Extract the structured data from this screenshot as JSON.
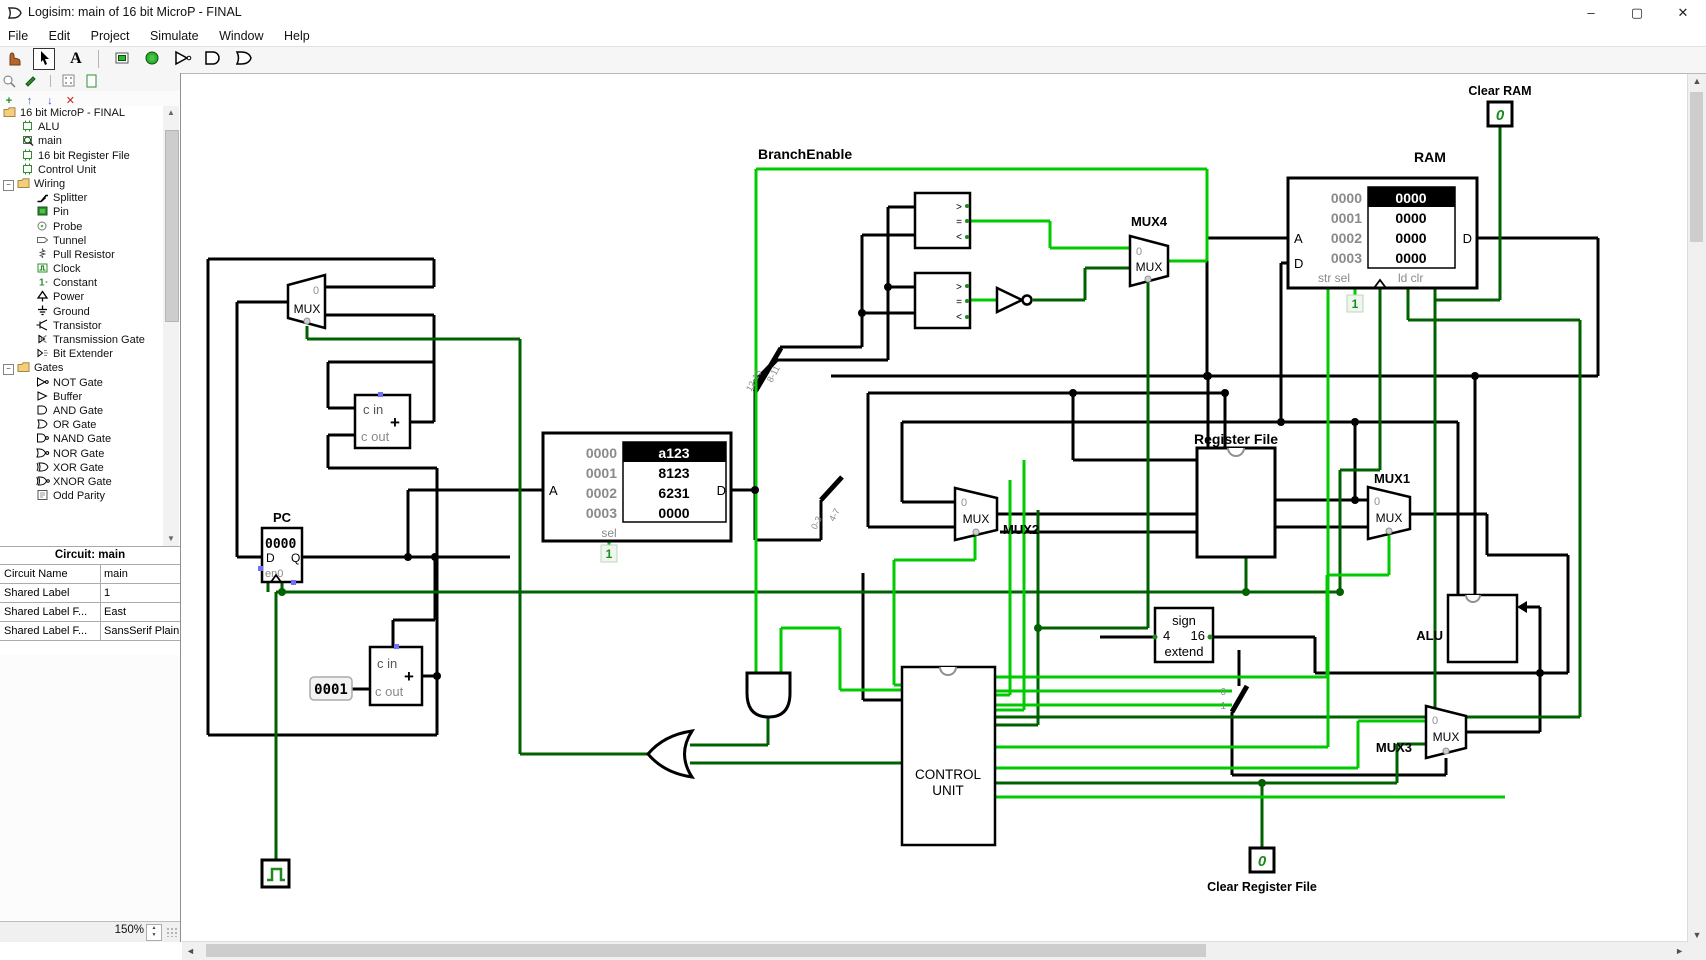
{
  "window": {
    "title": "Logisim: main of 16 bit MicroP - FINAL",
    "controls": {
      "minimize": "–",
      "maximize": "▢",
      "close": "✕"
    }
  },
  "menu": {
    "items": [
      "File",
      "Edit",
      "Project",
      "Simulate",
      "Window",
      "Help"
    ]
  },
  "toolbar": {
    "text_tool_glyph": "A",
    "tools": [
      "poke-tool",
      "edit-tool",
      "text-tool",
      "input-pin",
      "output-pin",
      "not-gate",
      "and-gate",
      "or-gate"
    ]
  },
  "explorer_toolbar": {
    "add": "+",
    "up": "↑",
    "down": "↓",
    "delete": "✕"
  },
  "explorer": {
    "items": [
      {
        "label": "16 bit MicroP - FINAL",
        "type": "project"
      },
      {
        "label": "ALU",
        "type": "circuit"
      },
      {
        "label": "main",
        "type": "circuit-current"
      },
      {
        "label": "16 bit Register File",
        "type": "circuit"
      },
      {
        "label": "Control Unit",
        "type": "circuit"
      },
      {
        "label": "Wiring",
        "type": "folder"
      },
      {
        "label": "Splitter",
        "type": "splitter"
      },
      {
        "label": "Pin",
        "type": "pin"
      },
      {
        "label": "Probe",
        "type": "probe"
      },
      {
        "label": "Tunnel",
        "type": "tunnel"
      },
      {
        "label": "Pull Resistor",
        "type": "pull-resistor"
      },
      {
        "label": "Clock",
        "type": "clock"
      },
      {
        "label": "Constant",
        "type": "constant"
      },
      {
        "label": "Power",
        "type": "power"
      },
      {
        "label": "Ground",
        "type": "ground"
      },
      {
        "label": "Transistor",
        "type": "transistor"
      },
      {
        "label": "Transmission Gate",
        "type": "transmission-gate"
      },
      {
        "label": "Bit Extender",
        "type": "bit-extender"
      },
      {
        "label": "Gates",
        "type": "folder"
      },
      {
        "label": "NOT Gate",
        "type": "not-gate"
      },
      {
        "label": "Buffer",
        "type": "buffer"
      },
      {
        "label": "AND Gate",
        "type": "and-gate"
      },
      {
        "label": "OR Gate",
        "type": "or-gate"
      },
      {
        "label": "NAND Gate",
        "type": "nand-gate"
      },
      {
        "label": "NOR Gate",
        "type": "nor-gate"
      },
      {
        "label": "XOR Gate",
        "type": "xor-gate"
      },
      {
        "label": "XNOR Gate",
        "type": "xnor-gate"
      },
      {
        "label": "Odd Parity",
        "type": "odd-parity"
      }
    ]
  },
  "properties": {
    "header": "Circuit: main",
    "rows": [
      {
        "label": "Circuit Name",
        "value": "main"
      },
      {
        "label": "Shared Label",
        "value": "1"
      },
      {
        "label": "Shared Label F...",
        "value": "East"
      },
      {
        "label": "Shared Label F...",
        "value": "SansSerif Plain..."
      }
    ]
  },
  "statusbar": {
    "zoom": "150%"
  },
  "icons": {
    "scroll_up": "▲",
    "scroll_down": "▼",
    "scroll_left": "◄",
    "scroll_right": "►",
    "spin_up": "▲",
    "spin_down": "▼",
    "tree_collapse": "−"
  },
  "colors": {
    "wire_on": "#00ca00",
    "wire_off": "#006100",
    "bus": "#000000",
    "gray_text": "#808080",
    "pin_green": "#2f8f2f"
  },
  "canvas": {
    "labels": {
      "branch_enable": "BranchEnable",
      "register_file": "Register File",
      "alu": "ALU",
      "pc": "PC",
      "control_l1": "CONTROL",
      "control_l2": "UNIT"
    },
    "muxes": {
      "mux_text": "MUX",
      "zero": "0",
      "mux1": "MUX1",
      "mux2": "MUX2",
      "mux3": "MUX3",
      "mux4": "MUX4"
    },
    "ram": {
      "title": "RAM",
      "rows": [
        {
          "addr": "0000",
          "value": "0000"
        },
        {
          "addr": "0001",
          "value": "0000"
        },
        {
          "addr": "0002",
          "value": "0000"
        },
        {
          "addr": "0003",
          "value": "0000"
        }
      ],
      "port_a": "A",
      "port_d_in": "D",
      "port_d_out": "D",
      "bottom_left": "str sel",
      "bottom_right": "ld  clr",
      "sel_const": "1"
    },
    "rom": {
      "rows": [
        {
          "addr": "0000",
          "value": "a123"
        },
        {
          "addr": "0001",
          "value": "8123"
        },
        {
          "addr": "0002",
          "value": "6231"
        },
        {
          "addr": "0003",
          "value": "0000"
        }
      ],
      "port_a": "A",
      "port_d": "D",
      "sel": "sel",
      "sel_const": "1"
    },
    "pc": {
      "value": "0000",
      "d": "D",
      "q": "Q",
      "en": "en0"
    },
    "adder": {
      "cin": "c in",
      "cout": "c out",
      "plus": "+"
    },
    "probe_value": "0001",
    "comparator": {
      "gt": ">",
      "eq": "=",
      "lt": "<"
    },
    "sign_extend": {
      "l1": "sign",
      "from": "4",
      "to": "16",
      "l3": "extend"
    },
    "clear_ram": {
      "label": "Clear RAM",
      "value": "0"
    },
    "clear_rf": {
      "label": "Clear Register File",
      "value": "0"
    },
    "splitters": {
      "s1a": "12-15",
      "s1b": "8-11",
      "s2a": "0-3",
      "s2b": "4-7",
      "b0": "0",
      "b1": "1"
    }
  }
}
